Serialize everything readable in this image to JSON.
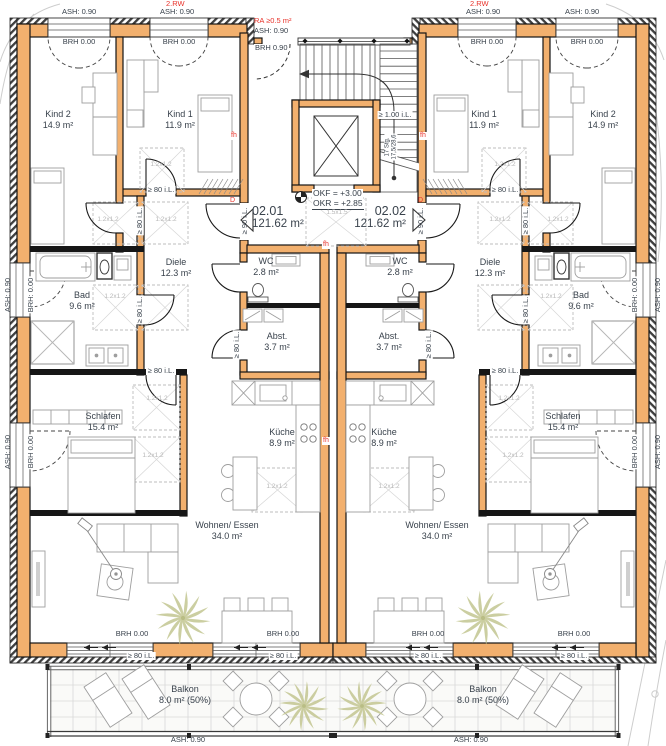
{
  "tags": {
    "floor": "2.RW",
    "ash090": "ASH: 0.90",
    "brh000": "BRH 0.00",
    "brh000c": "BRH: 0.00",
    "brh090": "BRH 0.90",
    "ra": "RA ≥0.5 m²",
    "okf": "OKF = +3.00",
    "okr": "OKR = +2.85",
    "sky12": "1.2x1.2",
    "sky15": "1.5x1.5",
    "c80": "≥ 80 i.L.",
    "c90": "≥ 90 i.L.",
    "c100": "≥ 1.00 i.L.",
    "stg1": "17 Stg.",
    "stg2": "17,5/28,6",
    "fh": "fh",
    "d": "D"
  },
  "units": {
    "left": {
      "id": "02.01",
      "area": "121.62 m²"
    },
    "right": {
      "id": "02.02",
      "area": "121.62 m²"
    }
  },
  "rooms": {
    "kind2": {
      "name": "Kind 2",
      "area": "14.9 m²"
    },
    "kind1": {
      "name": "Kind 1",
      "area": "11.9 m²"
    },
    "diele": {
      "name": "Diele",
      "area": "12.3 m²"
    },
    "bad": {
      "name": "Bad",
      "area": "9.6 m²"
    },
    "wc": {
      "name": "WC",
      "area": "2.8 m²"
    },
    "abst": {
      "name": "Abst.",
      "area": "3.7 m²"
    },
    "kueche": {
      "name": "Küche",
      "area": "8.9 m²"
    },
    "schlafen": {
      "name": "Schlafen",
      "area": "15.4 m²"
    },
    "wohnen": {
      "name": "Wohnen/ Essen",
      "area": "34.0 m²"
    },
    "balkon": {
      "name": "Balkon",
      "area": "8.0 m² (50%)"
    }
  }
}
